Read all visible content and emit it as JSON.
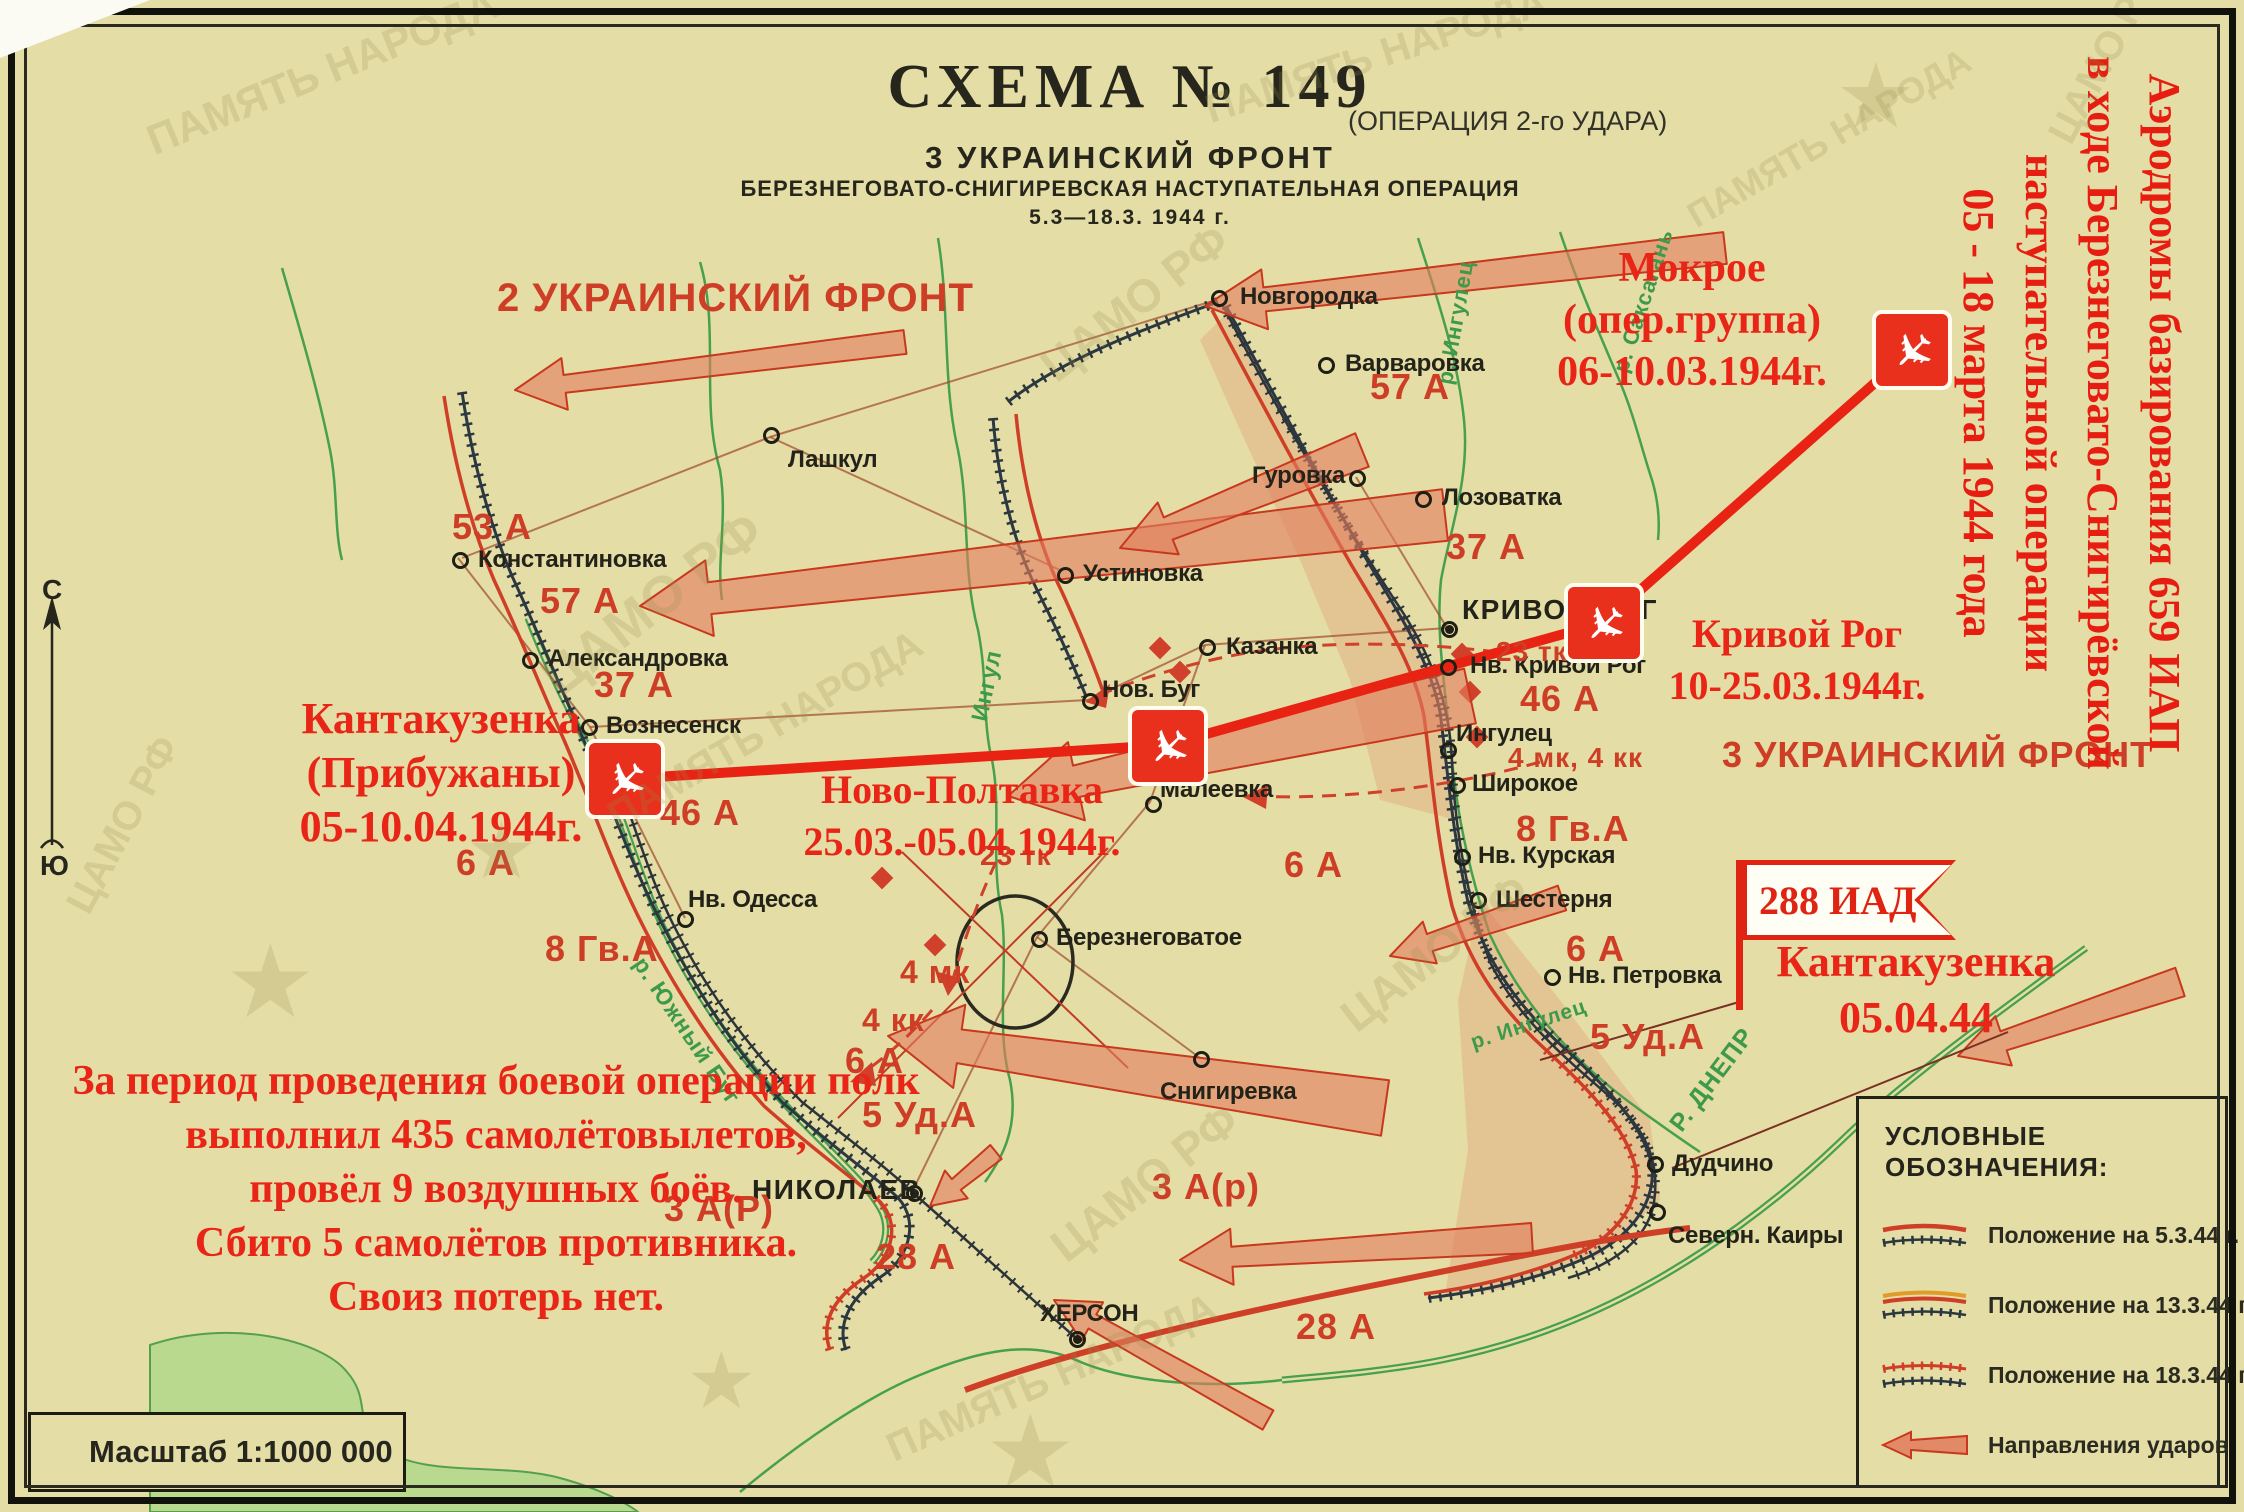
{
  "colors": {
    "paper": "#e4dda5",
    "annotation_red": "#e82516",
    "map_red": "#ce3e26",
    "front_dark": "#2c3840",
    "river_green": "#46a04e",
    "arrow_fill": "#e28a68"
  },
  "title": {
    "schema": "СХЕМА  №  149",
    "operation_note": "(ОПЕРАЦИЯ 2-го УДАРА)",
    "front": "3  УКРАИНСКИЙ  ФРОНТ",
    "operation": "БЕРЕЗНЕГОВАТО-СНИГИРЕВСКАЯ  НАСТУПАТЕЛЬНАЯ  ОПЕРАЦИЯ",
    "dates": "5.3—18.3. 1944 г."
  },
  "side_annotation": {
    "lines": [
      "Аэродромы базирования 659 ИАП",
      "в ходе Березнеговато-Снигирёвской",
      "наступательной операции",
      "05 - 18 марта 1944 года"
    ]
  },
  "annotations": {
    "airfields": [
      {
        "name": "mokroe",
        "lines": [
          "Мокрое",
          "(опер.группа)",
          "06-10.03.1944г."
        ],
        "box": {
          "x": 1522,
          "y": 242,
          "w": 340,
          "s": 42,
          "lh": 52
        },
        "icon": {
          "x": 1872,
          "y": 310
        }
      },
      {
        "name": "krivoy-rog",
        "lines": [
          "Кривой Рог",
          "10-25.03.1944г."
        ],
        "box": {
          "x": 1642,
          "y": 608,
          "w": 310,
          "s": 40,
          "lh": 52
        },
        "icon": {
          "x": 1564,
          "y": 583
        }
      },
      {
        "name": "novo-poltavka",
        "lines": [
          "Ново-Полтавка",
          "25.03.-05.04.1944г."
        ],
        "box": {
          "x": 772,
          "y": 764,
          "w": 380,
          "s": 40,
          "lh": 52
        },
        "icon": {
          "x": 1128,
          "y": 706
        }
      },
      {
        "name": "kantakuzenka-pribuzhany",
        "lines": [
          "Кантакузенка",
          "(Прибужаны)",
          "05-10.04.1944г."
        ],
        "box": {
          "x": 256,
          "y": 692,
          "w": 370,
          "s": 44,
          "lh": 54
        },
        "icon": {
          "x": 585,
          "y": 739
        }
      }
    ]
  },
  "division_flag": {
    "flag_text": "288 ИАД",
    "lines": [
      "Кантакузенка",
      "05.04.44"
    ]
  },
  "combat_summary": {
    "lines": [
      "За период проведения боевой операции полк",
      "выполнил 435 самолётовылетов,",
      "провёл 9 воздушных боёв.",
      "Сбито 5 самолётов противника.",
      "Своиз потерь нет."
    ]
  },
  "legend": {
    "title": "УСЛОВНЫЕ ОБОЗНАЧЕНИЯ:",
    "items": [
      {
        "label": "Положение на 5.3.44 г."
      },
      {
        "label": "Положение на 13.3.44 г."
      },
      {
        "label": "Положение на 18.3.44 г."
      },
      {
        "label": "Направления ударов"
      }
    ]
  },
  "scale": {
    "label": "Масштаб 1:1000 000"
  },
  "compass": {
    "north": "С",
    "south": "Ю"
  },
  "map": {
    "cities": [
      {
        "label": "Новгородка",
        "x": 1240,
        "y": 283,
        "cx": 1218,
        "cy": 297,
        "m": "o"
      },
      {
        "label": "Варваровка",
        "x": 1345,
        "y": 350,
        "cx": 1325,
        "cy": 364,
        "m": "o"
      },
      {
        "label": "Гуровка",
        "x": 1252,
        "y": 462,
        "cx": 1356,
        "cy": 477,
        "m": "o"
      },
      {
        "label": "Лозоватка",
        "x": 1442,
        "y": 484,
        "cx": 1422,
        "cy": 498,
        "m": "o"
      },
      {
        "label": "Лашкул",
        "x": 788,
        "y": 446,
        "cx": 770,
        "cy": 434,
        "m": "o"
      },
      {
        "label": "Константиновка",
        "x": 478,
        "y": 546,
        "cx": 459,
        "cy": 559,
        "m": "o"
      },
      {
        "label": "Устиновка",
        "x": 1083,
        "y": 560,
        "cx": 1064,
        "cy": 574,
        "m": "o"
      },
      {
        "label": "Александровка",
        "x": 548,
        "y": 645,
        "cx": 529,
        "cy": 659,
        "m": "o"
      },
      {
        "label": "Казанка",
        "x": 1226,
        "y": 633,
        "cx": 1206,
        "cy": 646,
        "m": "o"
      },
      {
        "label": "Вознесенск",
        "x": 606,
        "y": 712,
        "cx": 588,
        "cy": 726,
        "m": "o"
      },
      {
        "label": "Нов. Буг",
        "x": 1102,
        "y": 676,
        "cx": 1089,
        "cy": 700,
        "m": "o"
      },
      {
        "label": "Малеевка",
        "x": 1160,
        "y": 776,
        "cx": 1152,
        "cy": 803,
        "m": "o"
      },
      {
        "label": "КРИВОЙ РОГ",
        "x": 1462,
        "y": 594,
        "cx": 1448,
        "cy": 628,
        "m": "d",
        "big": true
      },
      {
        "label": "Нв. Кривой Рог",
        "x": 1470,
        "y": 652,
        "cx": 1447,
        "cy": 666,
        "m": "o"
      },
      {
        "label": "Ингулец",
        "x": 1456,
        "y": 720,
        "cx": 1447,
        "cy": 749,
        "m": "o"
      },
      {
        "label": "Широкое",
        "x": 1472,
        "y": 770,
        "cx": 1456,
        "cy": 784,
        "m": "o"
      },
      {
        "label": "Нв. Курская",
        "x": 1478,
        "y": 842,
        "cx": 1461,
        "cy": 856,
        "m": "o"
      },
      {
        "label": "Шестерня",
        "x": 1496,
        "y": 886,
        "cx": 1477,
        "cy": 899,
        "m": "o"
      },
      {
        "label": "Нв. Одесса",
        "x": 688,
        "y": 886,
        "cx": 684,
        "cy": 918,
        "m": "o"
      },
      {
        "label": "Березнеговатое",
        "x": 1056,
        "y": 924,
        "cx": 1038,
        "cy": 938,
        "m": "o"
      },
      {
        "label": "Нв. Петровка",
        "x": 1568,
        "y": 962,
        "cx": 1551,
        "cy": 976,
        "m": "o"
      },
      {
        "label": "Снигиревка",
        "x": 1160,
        "y": 1078,
        "cx": 1200,
        "cy": 1058,
        "m": "o"
      },
      {
        "label": "НИКОЛАЕВ",
        "x": 752,
        "y": 1174,
        "cx": 913,
        "cy": 1192,
        "m": "d",
        "big": true
      },
      {
        "label": "Дудчино",
        "x": 1672,
        "y": 1150,
        "cx": 1654,
        "cy": 1163,
        "m": "o"
      },
      {
        "label": "Северн. Каиры",
        "x": 1668,
        "y": 1222,
        "cx": 1656,
        "cy": 1211,
        "m": "o"
      },
      {
        "label": "ХЕРСОН",
        "x": 1040,
        "y": 1300,
        "cx": 1076,
        "cy": 1338,
        "m": "d"
      }
    ],
    "army_labels": [
      {
        "text": "2 УКРАИНСКИЙ ФРОНТ",
        "x": 497,
        "y": 276,
        "s": 40
      },
      {
        "text": "3 УКРАИНСКИЙ ФРОНТ",
        "x": 1722,
        "y": 734,
        "s": 36
      },
      {
        "text": "53 А",
        "x": 452,
        "y": 506,
        "s": 36
      },
      {
        "text": "57 А",
        "x": 540,
        "y": 580,
        "s": 36
      },
      {
        "text": "37 А",
        "x": 594,
        "y": 664,
        "s": 36
      },
      {
        "text": "46 А",
        "x": 660,
        "y": 792,
        "s": 36
      },
      {
        "text": "6 А",
        "x": 456,
        "y": 842,
        "s": 36
      },
      {
        "text": "8 Гв.А",
        "x": 545,
        "y": 928,
        "s": 36
      },
      {
        "text": "57 А",
        "x": 1370,
        "y": 366,
        "s": 36
      },
      {
        "text": "37 А",
        "x": 1446,
        "y": 526,
        "s": 36
      },
      {
        "text": "23 тк",
        "x": 1496,
        "y": 636,
        "s": 28
      },
      {
        "text": "46 А",
        "x": 1520,
        "y": 678,
        "s": 36
      },
      {
        "text": "4 мк, 4 кк",
        "x": 1508,
        "y": 742,
        "s": 28
      },
      {
        "text": "8 Гв.А",
        "x": 1516,
        "y": 808,
        "s": 36
      },
      {
        "text": "6 А",
        "x": 1566,
        "y": 928,
        "s": 36
      },
      {
        "text": "5 Уд.А",
        "x": 1590,
        "y": 1016,
        "s": 36
      },
      {
        "text": "23 тк",
        "x": 980,
        "y": 840,
        "s": 28
      },
      {
        "text": "4 мк",
        "x": 900,
        "y": 954,
        "s": 32
      },
      {
        "text": "4 кк",
        "x": 862,
        "y": 1002,
        "s": 32
      },
      {
        "text": "6 А",
        "x": 845,
        "y": 1040,
        "s": 36
      },
      {
        "text": "5 Уд.А",
        "x": 862,
        "y": 1094,
        "s": 36
      },
      {
        "text": "6 А",
        "x": 1284,
        "y": 844,
        "s": 36
      },
      {
        "text": "3 А(Р)",
        "x": 664,
        "y": 1188,
        "s": 36
      },
      {
        "text": "28 А",
        "x": 876,
        "y": 1236,
        "s": 36
      },
      {
        "text": "3 А(р)",
        "x": 1152,
        "y": 1166,
        "s": 36
      },
      {
        "text": "28 А",
        "x": 1296,
        "y": 1306,
        "s": 36
      }
    ],
    "river_labels": [
      {
        "text": "р. Ингулец",
        "x": 1432,
        "y": 382,
        "r": -80,
        "s": 22
      },
      {
        "text": "р. Саксагань",
        "x": 1608,
        "y": 368,
        "r": -72,
        "s": 22
      },
      {
        "text": "Ингул",
        "x": 966,
        "y": 718,
        "r": -78,
        "s": 23
      },
      {
        "text": "р. Южный Буг",
        "x": 650,
        "y": 952,
        "r": 56,
        "s": 23
      },
      {
        "text": "Р. ДНЕПР",
        "x": 1664,
        "y": 1120,
        "r": -53,
        "s": 25
      },
      {
        "text": "р. Ингулец",
        "x": 1468,
        "y": 1032,
        "r": -18,
        "s": 21
      }
    ],
    "watermarks": [
      {
        "text": "ЦАМО РФ",
        "x": 530,
        "y": 660,
        "r": -38,
        "s": 54
      },
      {
        "text": "ЦАМО РФ",
        "x": 1030,
        "y": 350,
        "r": -38,
        "s": 46
      },
      {
        "text": "ЦАМО РФ",
        "x": 1330,
        "y": 1000,
        "r": -38,
        "s": 46
      },
      {
        "text": "ЦАМО РФ",
        "x": 1040,
        "y": 1230,
        "r": -38,
        "s": 46
      },
      {
        "text": "ЦАМО РФ",
        "x": 2040,
        "y": 130,
        "r": -62,
        "s": 40
      },
      {
        "text": "ЦАМО РФ",
        "x": 58,
        "y": 900,
        "r": -62,
        "s": 40
      },
      {
        "text": "ПАМЯТЬ НАРОДА",
        "x": 140,
        "y": 120,
        "r": -22,
        "s": 42
      },
      {
        "text": "ПАМЯТЬ НАРОДА",
        "x": 1200,
        "y": 90,
        "r": -18,
        "s": 40
      },
      {
        "text": "ПАМЯТЬ НАРОДА",
        "x": 600,
        "y": 800,
        "r": -30,
        "s": 40
      },
      {
        "text": "ПАМЯТЬ НАРОДА",
        "x": 1680,
        "y": 200,
        "r": -30,
        "s": 36
      },
      {
        "text": "ПАМЯТЬ НАРОДА",
        "x": 880,
        "y": 1430,
        "r": -24,
        "s": 40
      },
      {
        "text": "★",
        "x": 230,
        "y": 930,
        "r": 0,
        "s": 90
      },
      {
        "text": "★",
        "x": 470,
        "y": 810,
        "r": 0,
        "s": 70
      },
      {
        "text": "★",
        "x": 990,
        "y": 1400,
        "r": 0,
        "s": 90
      },
      {
        "text": "★",
        "x": 1840,
        "y": 50,
        "r": 0,
        "s": 80
      },
      {
        "text": "★",
        "x": 690,
        "y": 1340,
        "r": 0,
        "s": 70
      }
    ]
  }
}
